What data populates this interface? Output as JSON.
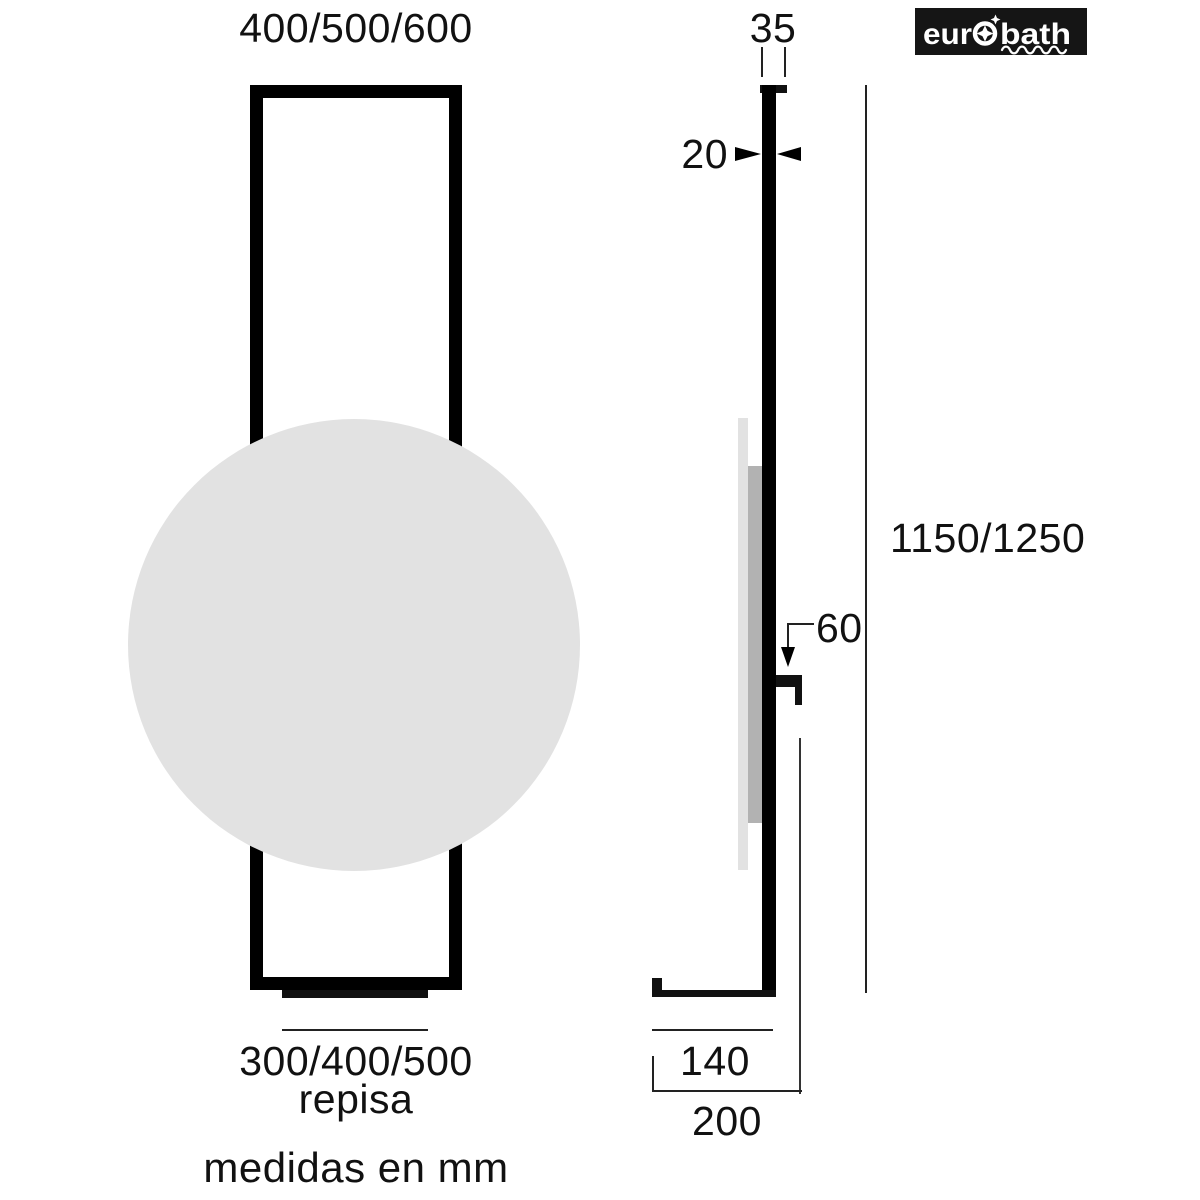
{
  "title": "eurobath mirror with shelf dimension drawing",
  "front_view": {
    "width_label": "400/500/600",
    "shelf_width_label": "300/400/500",
    "shelf_caption": "repisa"
  },
  "side_view": {
    "top_depth_label": "35",
    "panel_thickness_label": "20",
    "height_label": "1150/1250",
    "hook_offset_label": "60",
    "shelf_depth_label": "140",
    "total_depth_label": "200"
  },
  "footer": {
    "units_note": "medidas en mm"
  },
  "logo": {
    "text_left": "eur",
    "text_right": "bath",
    "o_icon": "four-point-star-in-circle",
    "underline_icon": "wavy-line"
  },
  "colors": {
    "line_black": "#111111",
    "thin_line": "#222222",
    "mirror_gray": "#e2e2e2",
    "backing_gray": "#b2b2b2",
    "logo_bg": "#151515",
    "logo_fg": "#ffffff"
  }
}
